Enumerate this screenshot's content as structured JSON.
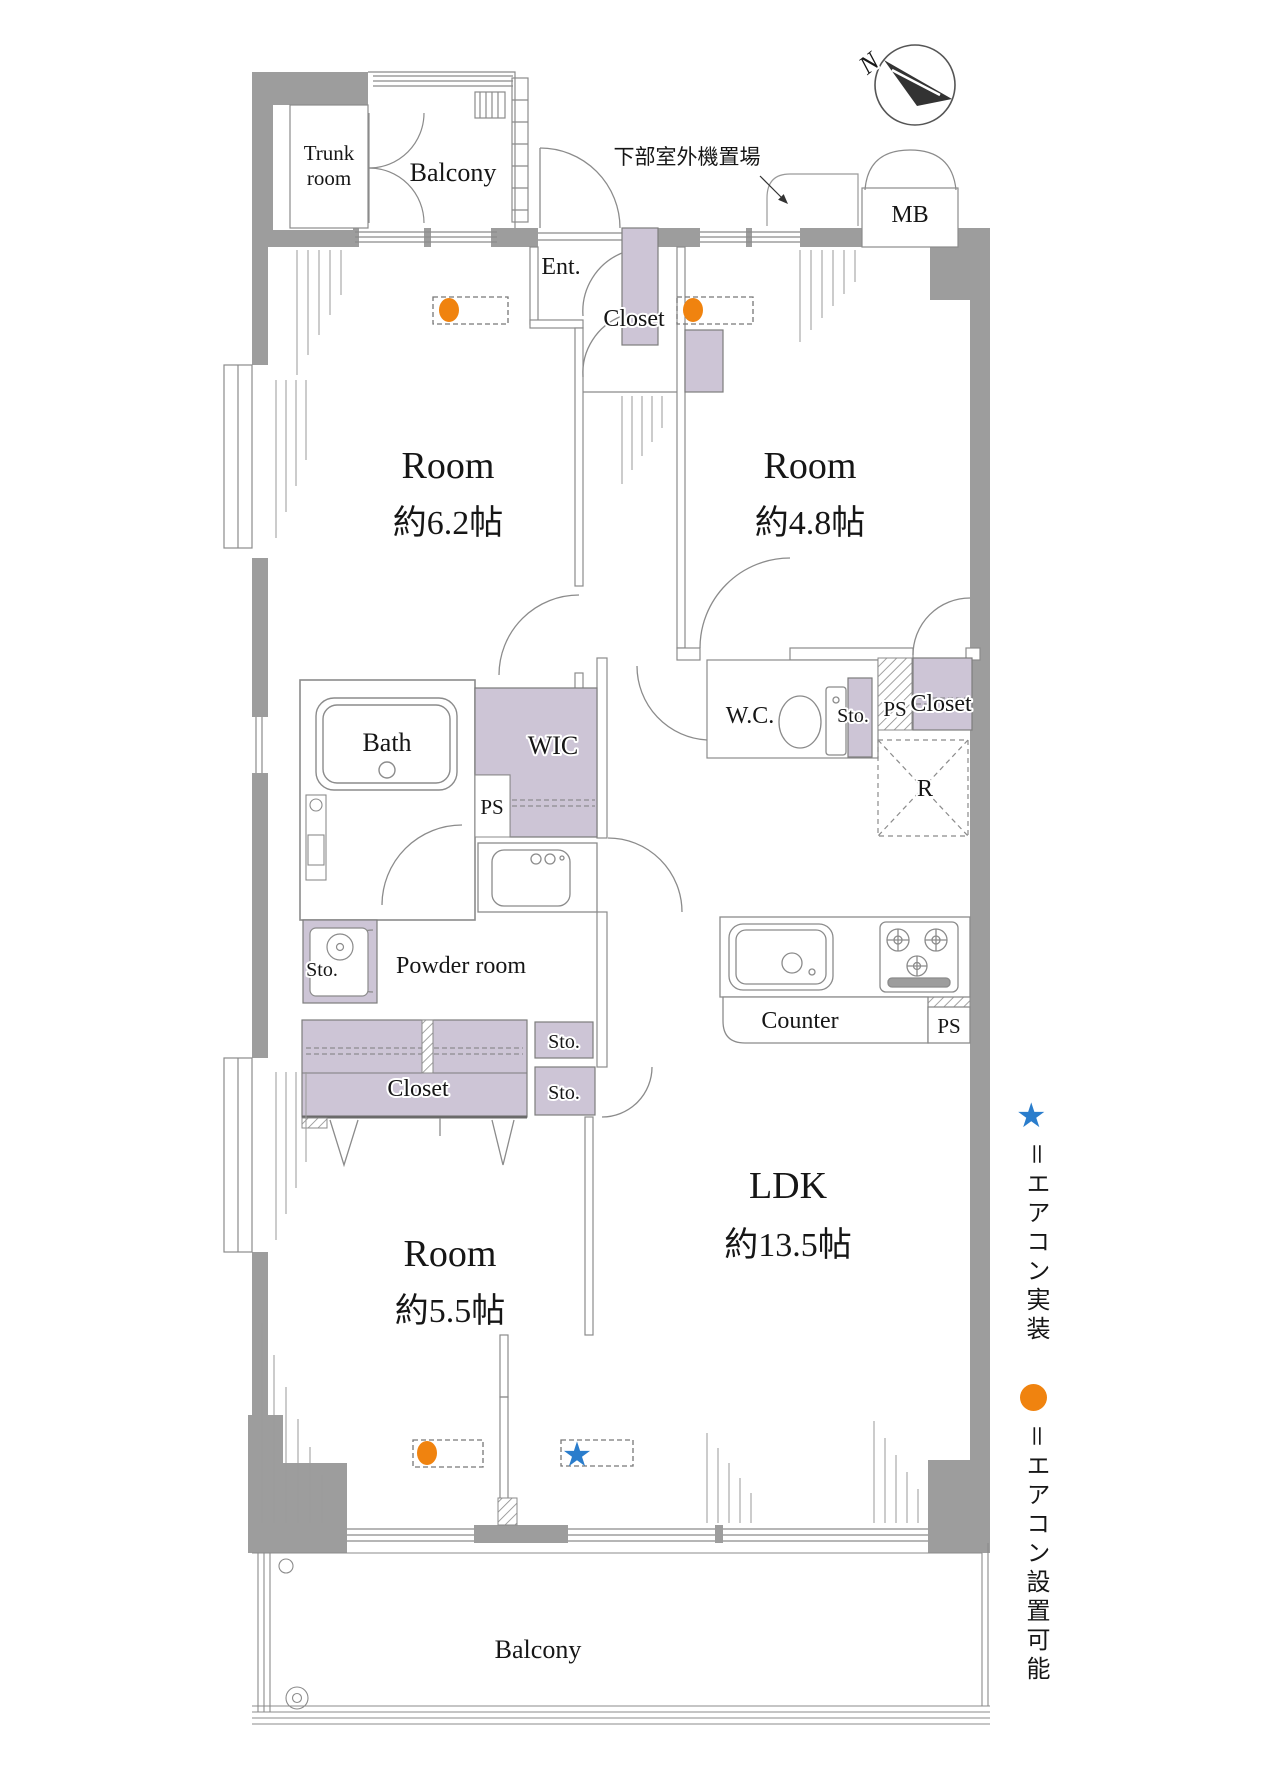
{
  "plan": {
    "compass": {
      "north": "N"
    },
    "labels": {
      "trunk_l1": "Trunk",
      "trunk_l2": "room",
      "balcony_top": "Balcony",
      "outdoor_unit": "下部室外機置場",
      "mb": "MB",
      "ent": "Ent.",
      "closet_ent": "Closet",
      "room62_name": "Room",
      "room62_size": "約6.2帖",
      "room48_name": "Room",
      "room48_size": "約4.8帖",
      "bath": "Bath",
      "wic": "WIC",
      "ps_wic": "PS",
      "wc": "W.C.",
      "sto_wc": "Sto.",
      "ps_wc": "PS",
      "closet_48": "Closet",
      "fridge": "R",
      "sto_powder": "Sto.",
      "powder_room": "Powder room",
      "counter": "Counter",
      "ps_kitchen": "PS",
      "closet_55": "Closet",
      "sto_1": "Sto.",
      "sto_2": "Sto.",
      "ldk_name": "LDK",
      "ldk_size": "約13.5帖",
      "room55_name": "Room",
      "room55_size": "約5.5帖",
      "balcony_bottom": "Balcony"
    },
    "legend": {
      "star": "★",
      "star_text": "＝エアコン実装",
      "dot_text": "＝エアコン設置可能"
    },
    "colors": {
      "wall": "#9d9d9d",
      "lavender": "#cdc5d6",
      "orange": "#f0830f",
      "blue": "#2a7dcc",
      "line": "#8b8b8b"
    }
  }
}
